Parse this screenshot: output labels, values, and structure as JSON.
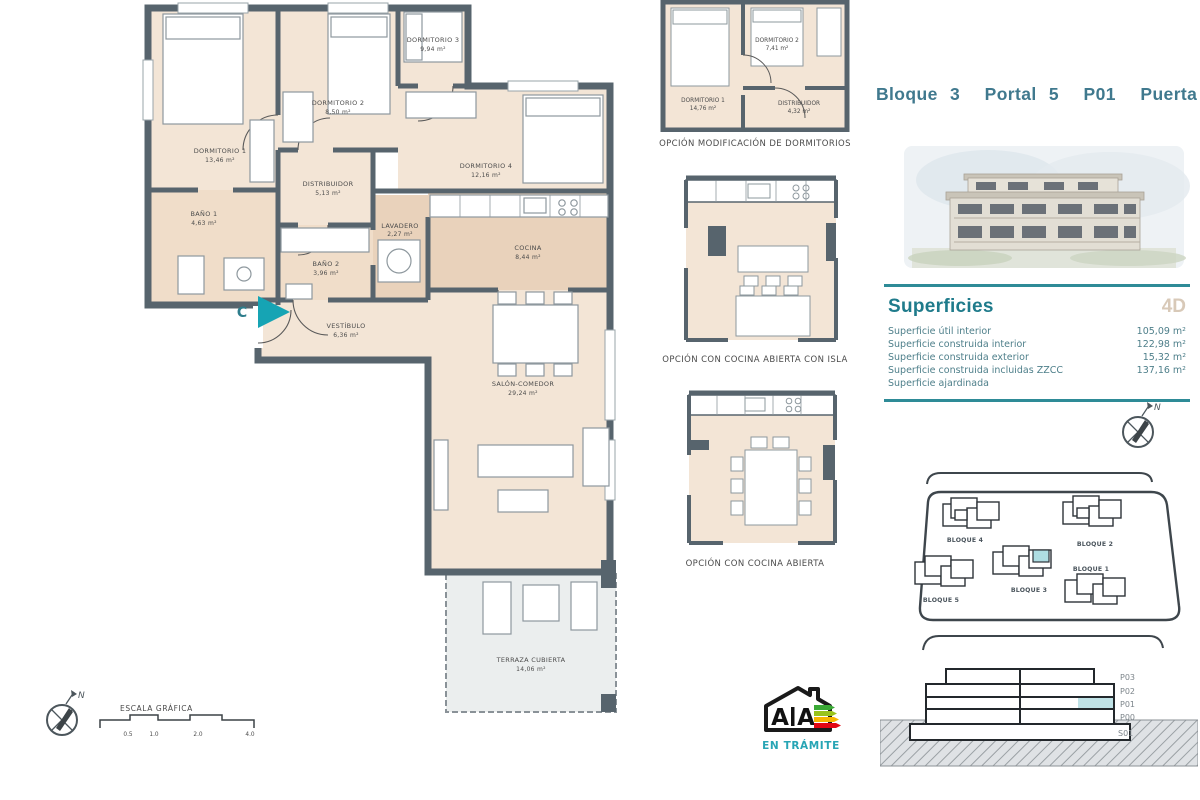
{
  "header": {
    "title": "Bloque 3  Portal 5  P01  Puerta C"
  },
  "main_plan": {
    "entry_label": "C",
    "rooms": {
      "dormitorio1": {
        "name": "DORMITORIO 1",
        "area": "13,46 m²"
      },
      "dormitorio2": {
        "name": "DORMITORIO 2",
        "area": "8,50 m²"
      },
      "dormitorio3": {
        "name": "DORMITORIO 3",
        "area": "9,94 m²"
      },
      "dormitorio4": {
        "name": "DORMITORIO 4",
        "area": "12,16 m²"
      },
      "bano1": {
        "name": "BAÑO 1",
        "area": "4,63 m²"
      },
      "bano2": {
        "name": "BAÑO 2",
        "area": "3,96 m²"
      },
      "distribuidor": {
        "name": "DISTRIBUIDOR",
        "area": "5,13 m²"
      },
      "vestibulo": {
        "name": "VESTÍBULO",
        "area": "6,36 m²"
      },
      "lavadero": {
        "name": "LAVADERO",
        "area": "2,27 m²"
      },
      "cocina": {
        "name": "COCINA",
        "area": "8,44 m²"
      },
      "salon": {
        "name": "SALÓN-COMEDOR",
        "area": "29,24 m²"
      },
      "terraza": {
        "name": "TERRAZA CUBIERTA",
        "area": "14,06 m²"
      }
    }
  },
  "options": {
    "option1": {
      "caption": "OPCIÓN MODIFICACIÓN DE DORMITORIOS",
      "rooms": {
        "dormitorio1": {
          "name": "DORMITORIO 1",
          "area": "14,76 m²"
        },
        "dormitorio2": {
          "name": "DORMITORIO 2",
          "area": "7,41 m²"
        },
        "distribuidor": {
          "name": "DISTRIBUIDOR",
          "area": "4,32 m²"
        }
      }
    },
    "option2": {
      "caption": "OPCIÓN CON COCINA ABIERTA CON ISLA"
    },
    "option3": {
      "caption": "OPCIÓN CON COCINA ABIERTA"
    }
  },
  "superficies": {
    "heading": "Superficies",
    "unit_type": "4D",
    "rows": [
      {
        "label": "Superficie útil interior",
        "value": "105,09 m²"
      },
      {
        "label": "Superficie construida interior",
        "value": "122,98 m²"
      },
      {
        "label": "Superficie construida exterior",
        "value": "15,32 m²"
      },
      {
        "label": "Superficie construida incluidas ZZCC",
        "value": "137,16 m²"
      },
      {
        "label": "Superficie ajardinada",
        "value": ""
      }
    ]
  },
  "site_plan": {
    "blocks": [
      {
        "label": "BLOQUE 4"
      },
      {
        "label": "BLOQUE 2"
      },
      {
        "label": "BLOQUE 5"
      },
      {
        "label": "BLOQUE 3"
      },
      {
        "label": "BLOQUE 1"
      }
    ]
  },
  "elevation": {
    "floors": [
      "P03",
      "P02",
      "P01",
      "P00",
      "S01"
    ]
  },
  "scale_bar": {
    "label": "ESCALA GRÁFICA",
    "ticks": [
      "0.5",
      "1.0",
      "2.0",
      "4.0"
    ]
  },
  "energy": {
    "letter": "A",
    "status": "EN TRÁMITE"
  },
  "compass": {
    "north": "N"
  },
  "colors": {
    "accent_teal": "#2e8b97",
    "highlight_teal": "#aedde2",
    "wall": "#57646d",
    "room_fill": "#f3e5d6",
    "service_fill": "#e9d2bb",
    "terrace_fill": "#ebeeee"
  }
}
